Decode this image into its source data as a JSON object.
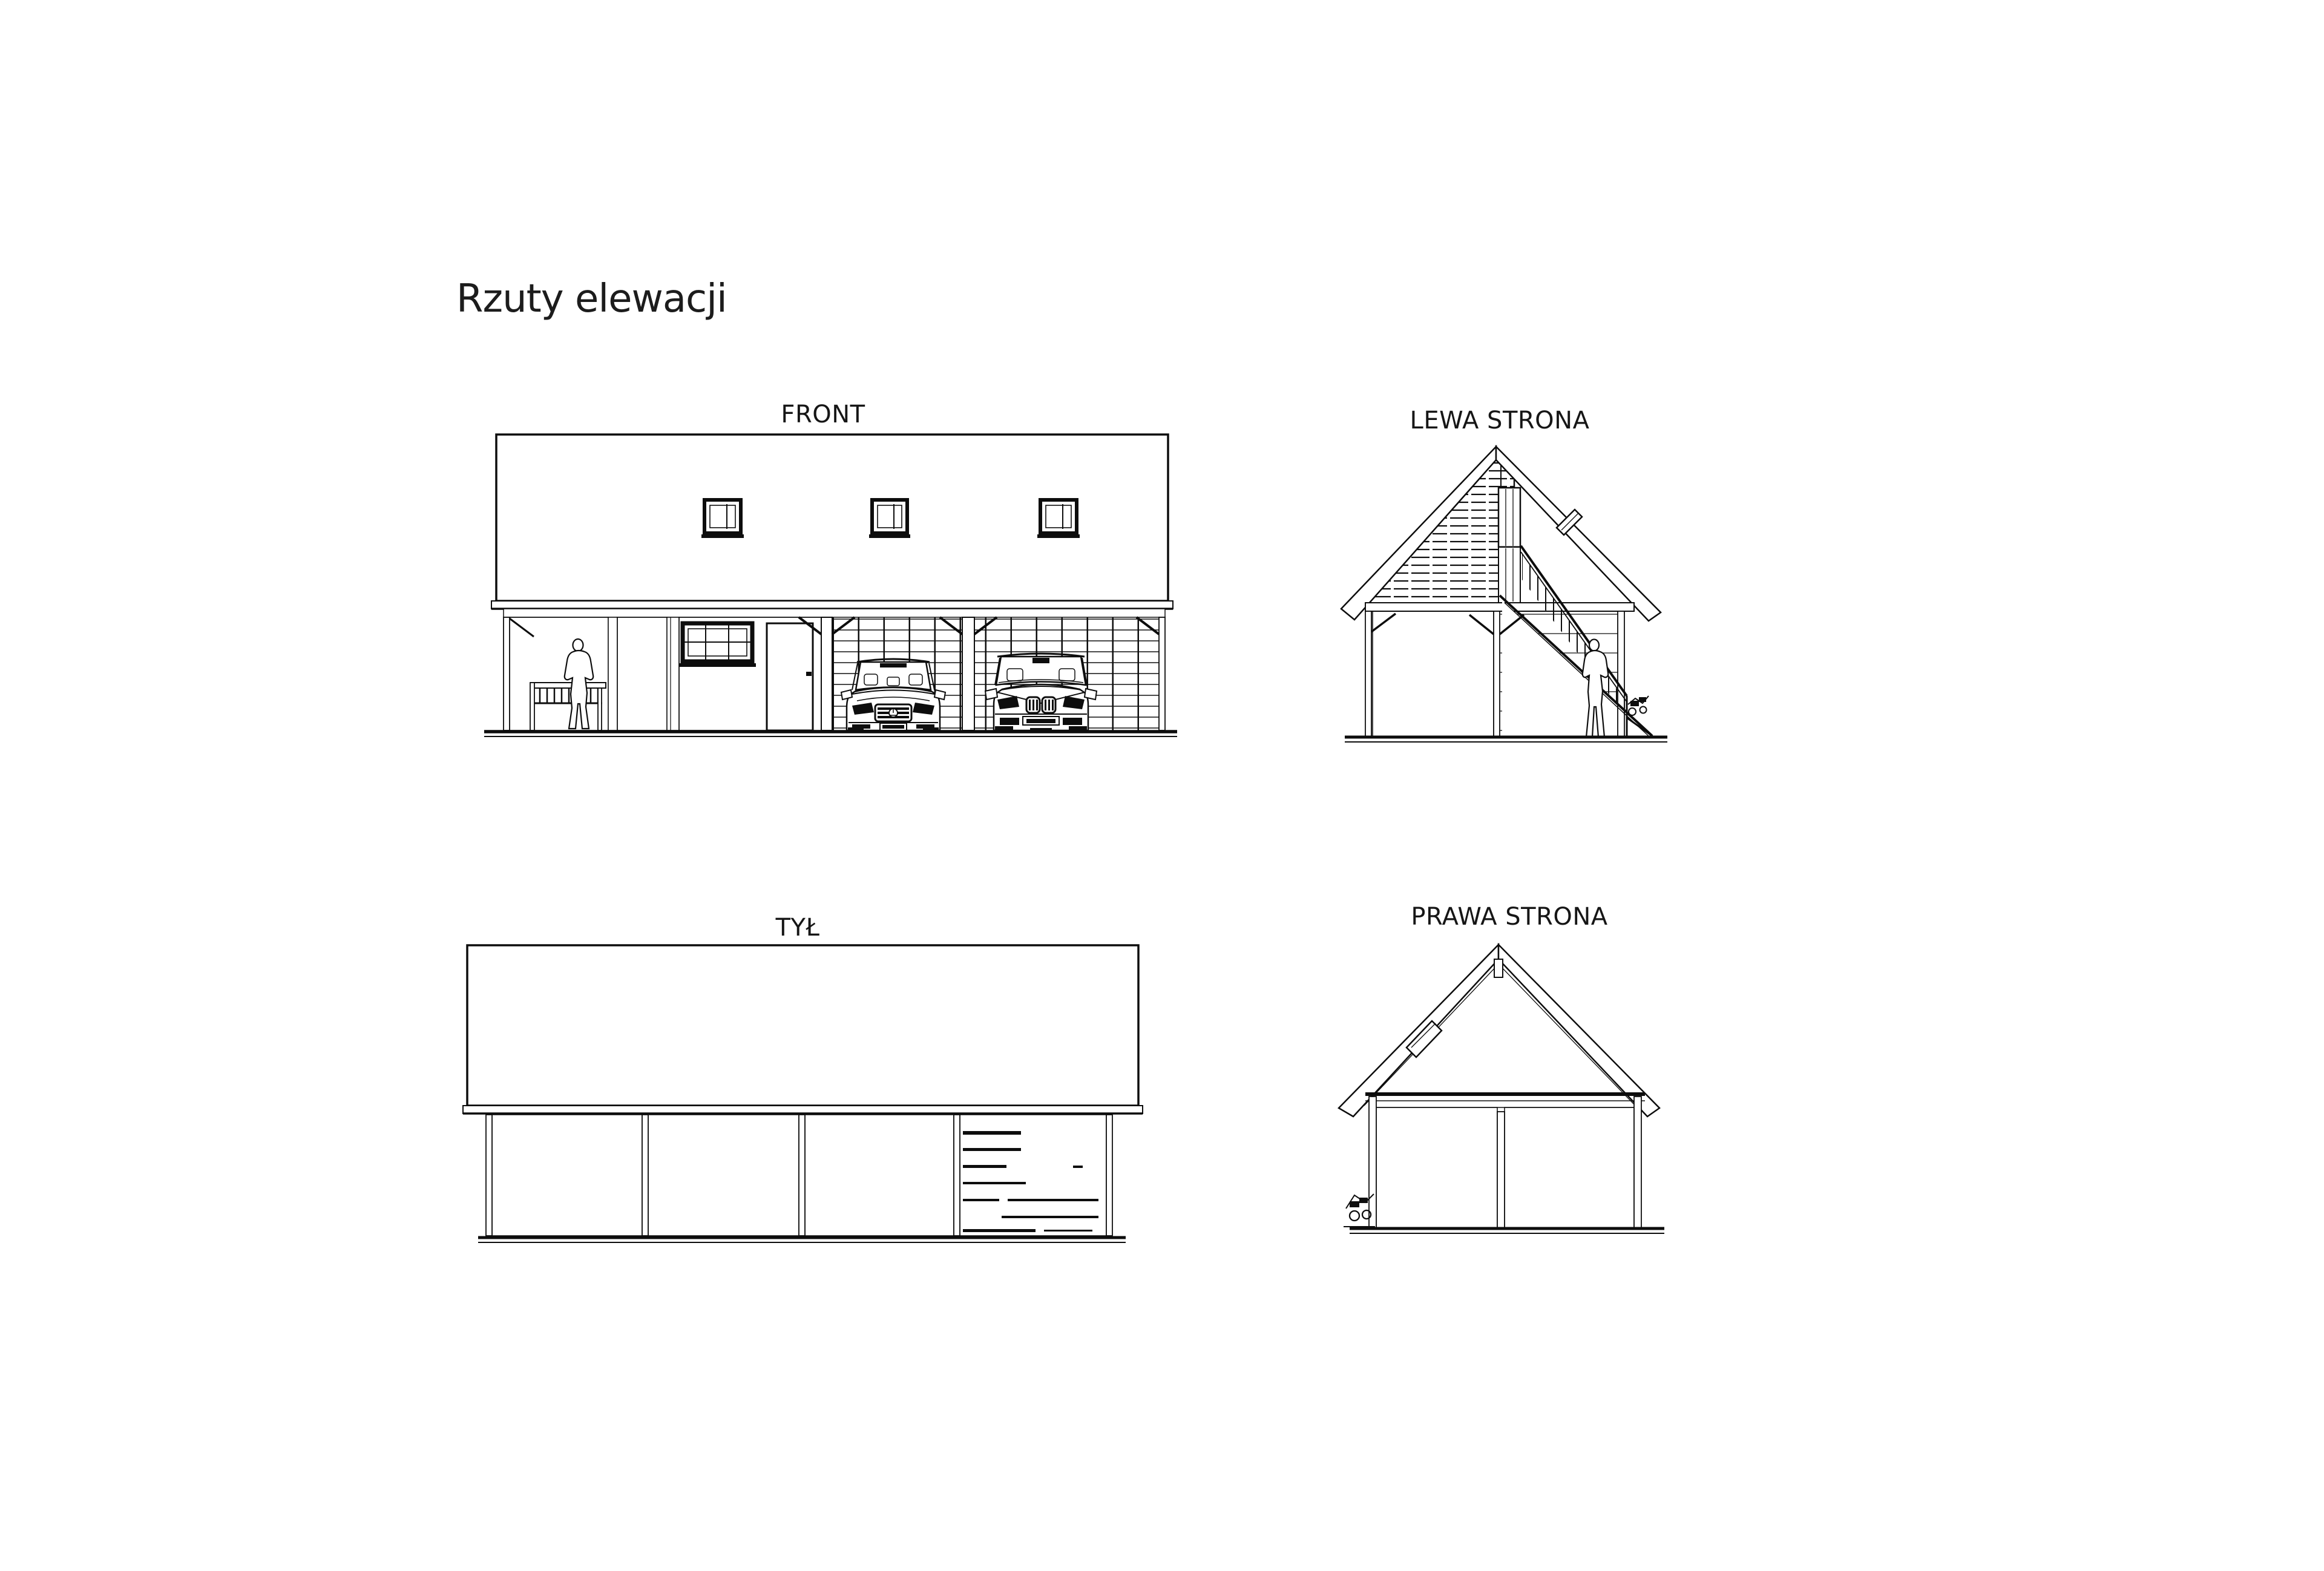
{
  "page": {
    "title": "Rzuty elewacji",
    "background_color": "#ffffff",
    "line_color": "#0d0d0d"
  },
  "elevations": {
    "front": {
      "label": "FRONT"
    },
    "left": {
      "label": "LEWA STRONA"
    },
    "back": {
      "label": "TYŁ"
    },
    "right": {
      "label": "PRAWA STRONA"
    }
  }
}
